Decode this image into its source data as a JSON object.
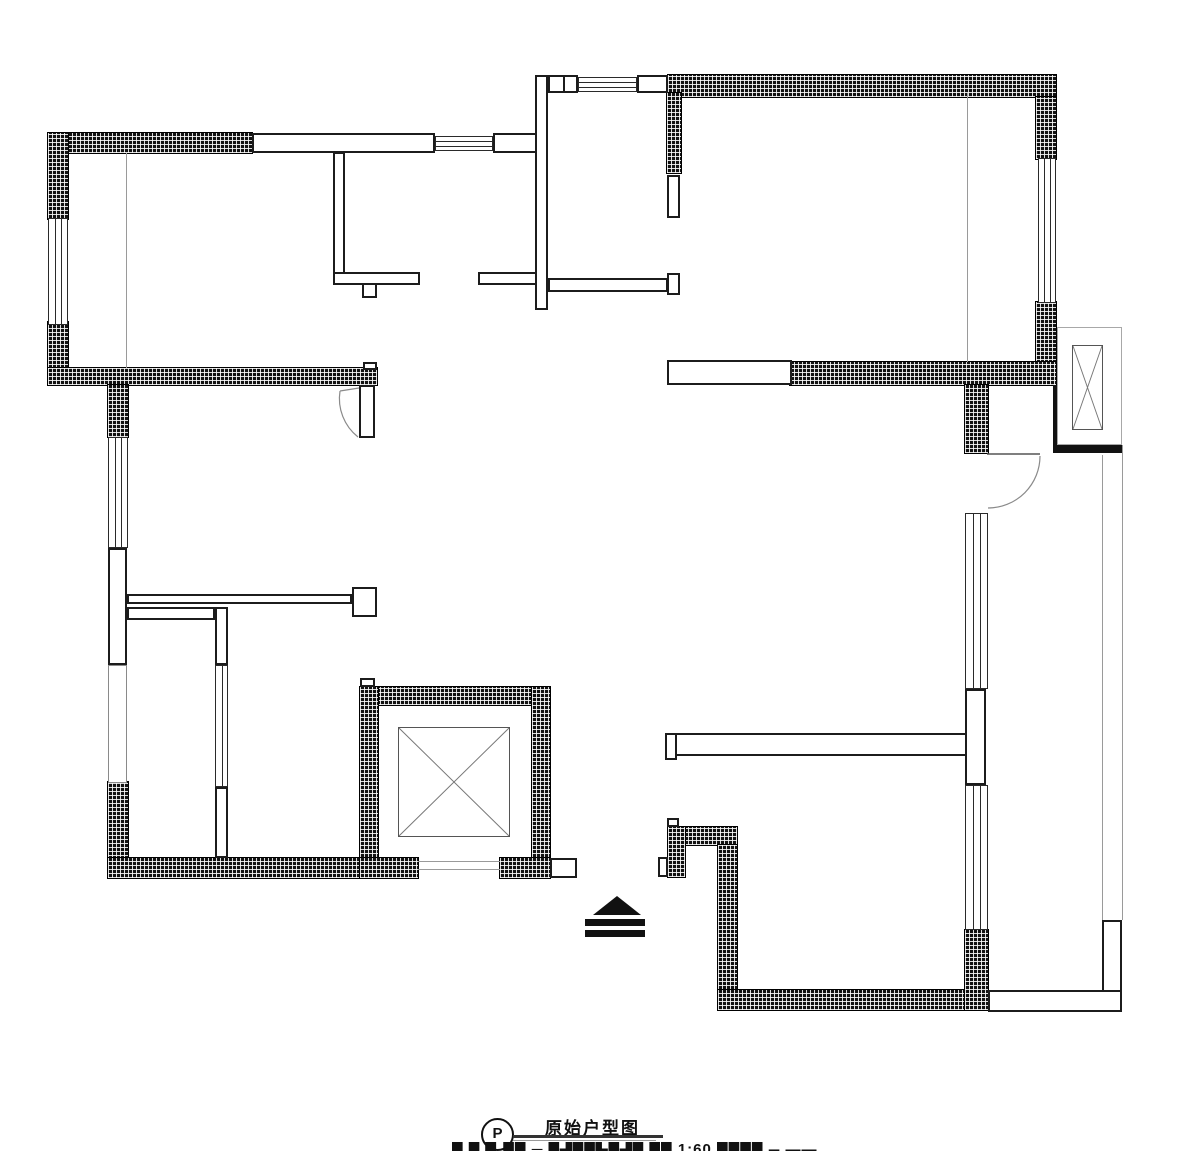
{
  "title_block": {
    "symbol_letter": "P",
    "title": "原始户型图",
    "caption_fragment": "█ █ ▉ ██ ─ █▟██▙█▟█ ██ 1:60 ████ ▄ ▬▬"
  },
  "colors": {
    "wall_hatch": "#121212",
    "wall_line": "#1c1c1c",
    "light_line": "#9a9a9a",
    "background": "#ffffff"
  },
  "floorplan": {
    "hatched_walls": [
      [
        48,
        133,
        204,
        20
      ],
      [
        48,
        133,
        20,
        86
      ],
      [
        48,
        322,
        20,
        63
      ],
      [
        48,
        368,
        329,
        17
      ],
      [
        108,
        385,
        20,
        52
      ],
      [
        108,
        782,
        20,
        78
      ],
      [
        108,
        858,
        252,
        20
      ],
      [
        668,
        75,
        388,
        22
      ],
      [
        667,
        93,
        14,
        80
      ],
      [
        1036,
        97,
        20,
        62
      ],
      [
        1036,
        302,
        20,
        62
      ],
      [
        790,
        362,
        266,
        23
      ],
      [
        965,
        385,
        23,
        68
      ],
      [
        360,
        687,
        190,
        18
      ],
      [
        360,
        687,
        18,
        191
      ],
      [
        532,
        687,
        18,
        191
      ],
      [
        360,
        858,
        58,
        20
      ],
      [
        500,
        858,
        50,
        20
      ],
      [
        668,
        827,
        69,
        18
      ],
      [
        668,
        827,
        17,
        50
      ],
      [
        718,
        845,
        19,
        165
      ],
      [
        718,
        990,
        247,
        20
      ],
      [
        965,
        930,
        23,
        80
      ]
    ],
    "hollow_walls": [
      [
        252,
        133,
        183,
        20
      ],
      [
        493,
        133,
        44,
        20
      ],
      [
        535,
        75,
        13,
        235
      ],
      [
        333,
        152,
        12,
        131
      ],
      [
        333,
        272,
        87,
        13
      ],
      [
        478,
        272,
        59,
        13
      ],
      [
        362,
        283,
        15,
        15
      ],
      [
        548,
        75,
        30,
        18
      ],
      [
        563,
        75,
        15,
        18
      ],
      [
        637,
        75,
        31,
        18
      ],
      [
        548,
        278,
        120,
        14
      ],
      [
        667,
        273,
        13,
        22
      ],
      [
        667,
        175,
        13,
        43
      ],
      [
        667,
        360,
        125,
        25
      ],
      [
        359,
        385,
        16,
        53
      ],
      [
        363,
        362,
        14,
        8
      ],
      [
        108,
        548,
        19,
        117
      ],
      [
        127,
        594,
        225,
        10
      ],
      [
        352,
        587,
        25,
        30
      ],
      [
        127,
        607,
        88,
        13
      ],
      [
        215,
        607,
        13,
        58
      ],
      [
        215,
        787,
        13,
        71
      ],
      [
        550,
        858,
        27,
        20
      ],
      [
        360,
        678,
        15,
        9
      ],
      [
        665,
        733,
        302,
        23
      ],
      [
        665,
        733,
        12,
        27
      ],
      [
        965,
        689,
        21,
        96
      ],
      [
        1102,
        920,
        20,
        72
      ],
      [
        988,
        990,
        134,
        22
      ],
      [
        658,
        857,
        10,
        20
      ],
      [
        667,
        818,
        12,
        9
      ]
    ],
    "solid_walls": [
      [
        1053,
        385,
        8,
        68
      ],
      [
        1053,
        443,
        69,
        10
      ]
    ],
    "windows": [
      {
        "x": 48,
        "y": 218,
        "w": 20,
        "h": 107,
        "dir": "v",
        "inner": 2,
        "light": false
      },
      {
        "x": 108,
        "y": 437,
        "w": 20,
        "h": 111,
        "dir": "v",
        "inner": 2,
        "light": false
      },
      {
        "x": 108,
        "y": 665,
        "w": 19,
        "h": 118,
        "dir": "v",
        "inner": 0,
        "light": true
      },
      {
        "x": 215,
        "y": 665,
        "w": 13,
        "h": 122,
        "dir": "v",
        "inner": 1,
        "light": false
      },
      {
        "x": 435,
        "y": 136,
        "w": 58,
        "h": 15,
        "dir": "h",
        "inner": 2,
        "light": false
      },
      {
        "x": 578,
        "y": 77,
        "w": 59,
        "h": 15,
        "dir": "h",
        "inner": 2,
        "light": false
      },
      {
        "x": 1038,
        "y": 158,
        "w": 18,
        "h": 145,
        "dir": "v",
        "inner": 2,
        "light": false
      },
      {
        "x": 965,
        "y": 513,
        "w": 23,
        "h": 176,
        "dir": "v",
        "inner": 2,
        "light": false
      },
      {
        "x": 965,
        "y": 785,
        "w": 23,
        "h": 145,
        "dir": "v",
        "inner": 2,
        "light": false
      }
    ],
    "gray_lines_v": [
      [
        126,
        153,
        215
      ],
      [
        967,
        93,
        269
      ],
      [
        1102,
        455,
        465
      ],
      [
        1122,
        445,
        475
      ]
    ],
    "gray_lines_h": [
      [
        418,
        861,
        82
      ],
      [
        418,
        869,
        82
      ]
    ],
    "elevator_outlines": [
      [
        1057,
        327,
        65,
        118
      ]
    ],
    "x_boxes": [
      [
        398,
        727,
        112,
        110
      ],
      [
        1072,
        345,
        31,
        85
      ]
    ],
    "door_paths": [
      {
        "d": "M987,454 L1040,454",
        "stroke": "#555",
        "w": 1.5
      },
      {
        "d": "M1040,456 A52,52 0 0 1 988,508",
        "stroke": "#8a8a8a",
        "w": 1.2
      },
      {
        "d": "M359,388 L340,391",
        "stroke": "#8a8a8a",
        "w": 1.2
      },
      {
        "d": "M340,391 A49,49 0 0 0 358,437",
        "stroke": "#8a8a8a",
        "w": 1.2
      }
    ],
    "entry_symbol": {
      "triangle": "593,915 617,896 641,915",
      "bars": [
        [
          585,
          919,
          60,
          7
        ],
        [
          585,
          930,
          60,
          7
        ]
      ]
    }
  }
}
